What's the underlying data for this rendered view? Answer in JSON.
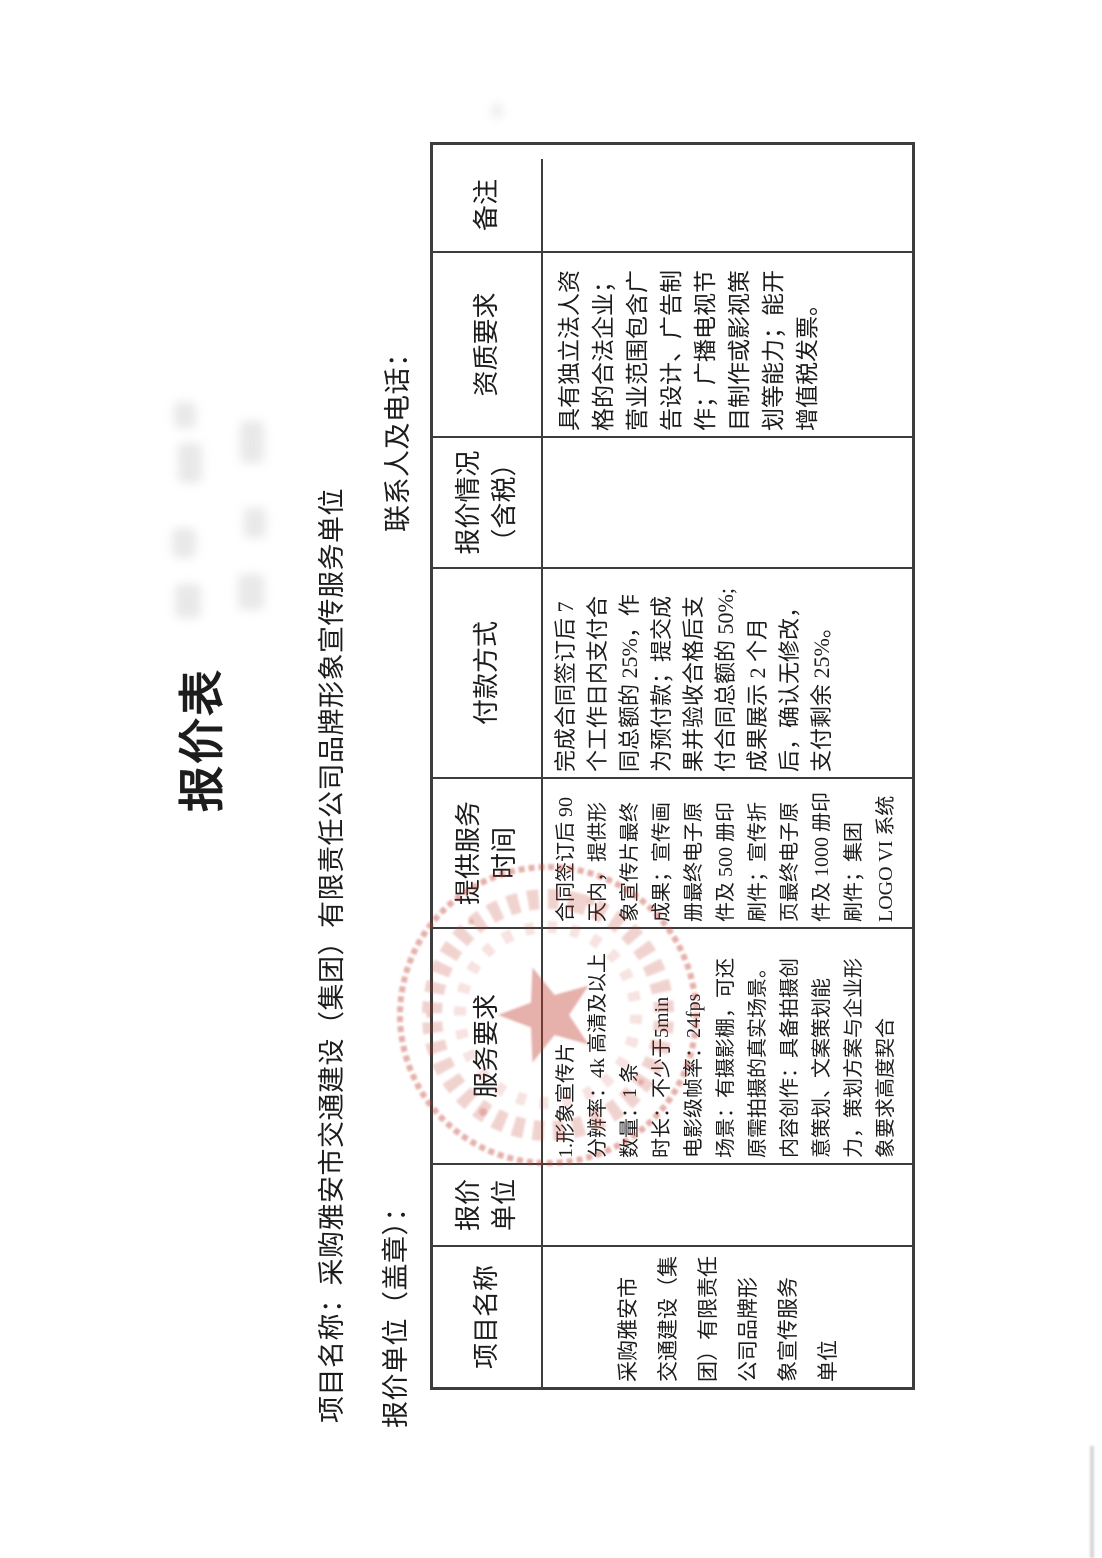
{
  "document": {
    "title": "报价表",
    "meta": {
      "project_line": "项目名称：采购雅安市交通建设（集团）有限责任公司品牌形象宣传服务单位",
      "quote_unit_line": "报价单位（盖章）：",
      "contact_line": "联系人及电话："
    },
    "table": {
      "columns": [
        {
          "header": "项目名称",
          "content": "采购雅安市\n交通建设（集\n团）有限责任\n公司品牌形\n象宣传服务\n单位"
        },
        {
          "header": "报价\n单位",
          "content": ""
        },
        {
          "header": "服务要求",
          "content": "1.形象宣传片\n分辨率：4k 高清及以上\n数量：1 条\n时长：不少于5min\n电影级帧率：24fps\n场景：有摄影棚，可还\n原需拍摄的真实场景。\n内容创作：具备拍摄创\n意策划、文案策划能\n力，策划方案与企业形\n象要求高度契合"
        },
        {
          "header": "提供服务\n时间",
          "content": "合同签订后 90\n天内，提供形\n象宣传片最终\n成果；宣传画\n册最终电子原\n件及 500 册印\n刷件；宣传折\n页最终电子原\n件及 1000 册印\n刷件；集团\nLOGO VI 系统"
        },
        {
          "header": "付款方式",
          "content": "完成合同签订后 7\n个工作日内支付合\n同总额的 25%，作\n为预付款；提交成\n果并验收合格后支\n付合同总额的 50%;\n成果展示 2 个月\n后，确认无修改，\n支付剩余 25%。"
        },
        {
          "header": "报价情况\n（含税）",
          "content": ""
        },
        {
          "header": "资质要求",
          "content": "具有独立法人资\n格的合法企业；\n营业范围包含广\n告设计、广告制\n作；广播电视节\n目制作或影视策\n划等能力；能开\n增值税发票。"
        },
        {
          "header": "备注",
          "content": ""
        }
      ]
    },
    "stamp": {
      "shape": "circular-seal-with-star",
      "color": "#c0392b"
    }
  }
}
